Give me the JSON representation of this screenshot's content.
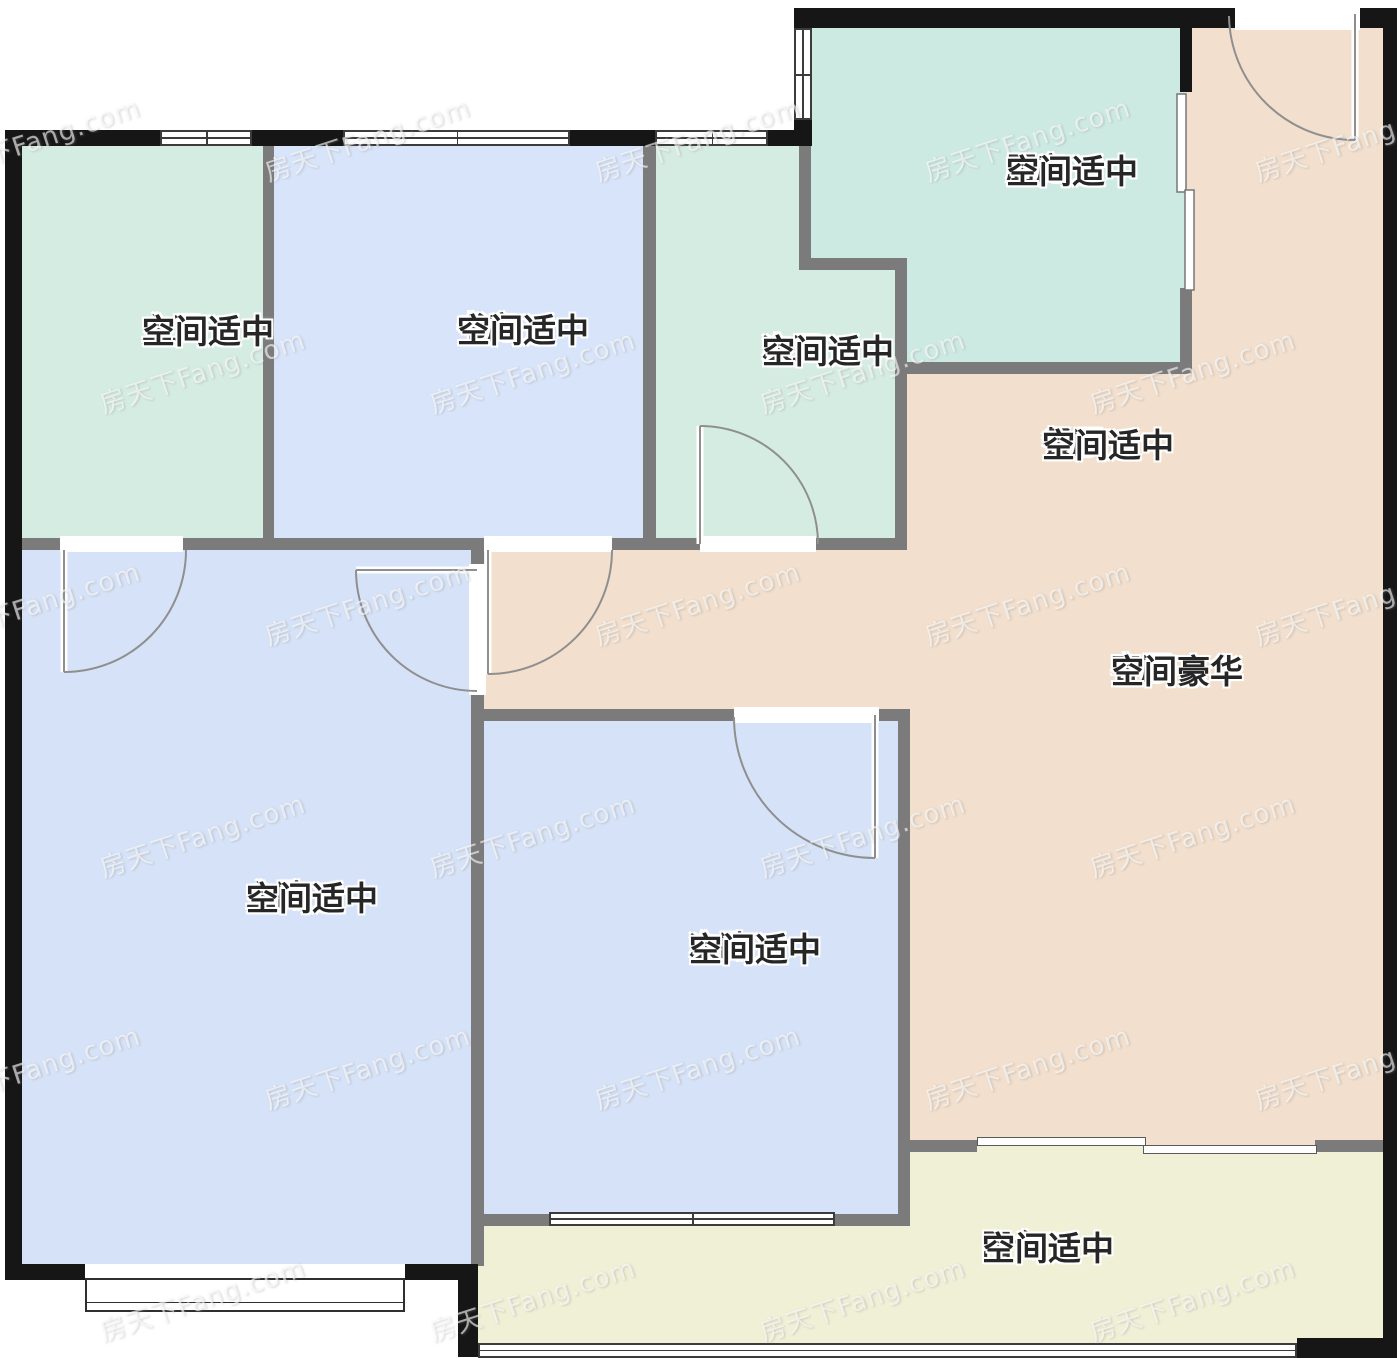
{
  "plan_title": "房型图",
  "watermark": {
    "text": "房天下Fang.com"
  },
  "rooms": [
    {
      "id": "kitchen",
      "name": "厨房",
      "grade": "空间适中",
      "color": "#cdeae2"
    },
    {
      "id": "master-bath",
      "name": "主卫",
      "grade": "空间适中",
      "color": "#d5ece2"
    },
    {
      "id": "study",
      "name": "书房",
      "grade": "空间适中",
      "color": "#d8e4f9"
    },
    {
      "id": "second-bath",
      "name": "次卫",
      "grade": "空间适中",
      "color": "#d5ece2"
    },
    {
      "id": "dining",
      "name": "餐厅",
      "grade": "空间适中",
      "color": "#f2dfcd"
    },
    {
      "id": "living",
      "name": "客厅",
      "grade": "空间豪华",
      "color": "#f2dfcd"
    },
    {
      "id": "master-bedroom",
      "name": "主卧",
      "grade": "空间适中",
      "color": "#d6e2f7"
    },
    {
      "id": "second-bedroom",
      "name": "次卧",
      "grade": "空间适中",
      "color": "#d6e2f7"
    },
    {
      "id": "balcony",
      "name": "阳台",
      "grade": "空间适中",
      "color": "#eff0d6"
    }
  ],
  "colors": {
    "exterior_wall": "#161616",
    "interior_wall": "#7b7b7b",
    "door_arc": "#8f8f8f",
    "window_line": "#3c3c3c"
  }
}
